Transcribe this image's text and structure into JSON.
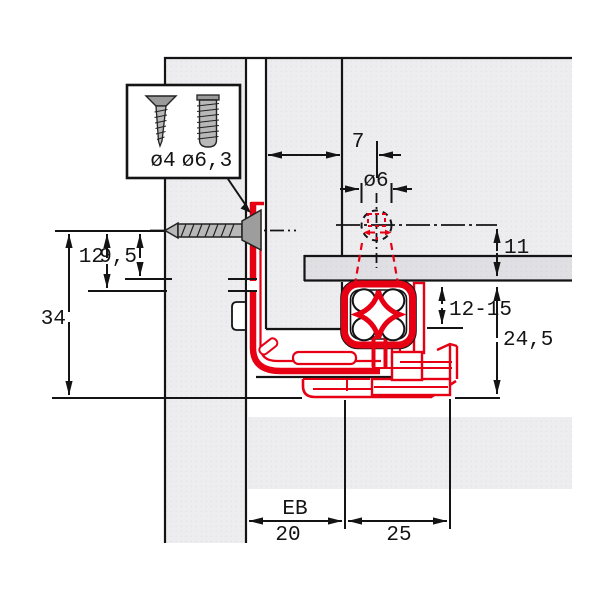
{
  "diagram": {
    "type": "technical-installation-drawing",
    "subject": "Concealed drawer runner mounting cross-section",
    "colors": {
      "profile_red": "#e70014",
      "panel_gray": "#ededef",
      "bar_gray": "#e1e1e4",
      "line_black": "#141414"
    },
    "inset_box": {
      "screw_countersunk": "ø4",
      "screw_euro": "ø6,3"
    },
    "dims": {
      "edge_to_hole": "7",
      "hole_diameter": "ø6",
      "axis_to_bottom": "11",
      "pin_length": "12-15",
      "runner_clearance": "24,5",
      "total_drop": "34",
      "bracket_drop": "12",
      "bottom_drop": "9,5",
      "eb_label": "EB",
      "eb_value": "20",
      "rear_width": "25"
    }
  }
}
